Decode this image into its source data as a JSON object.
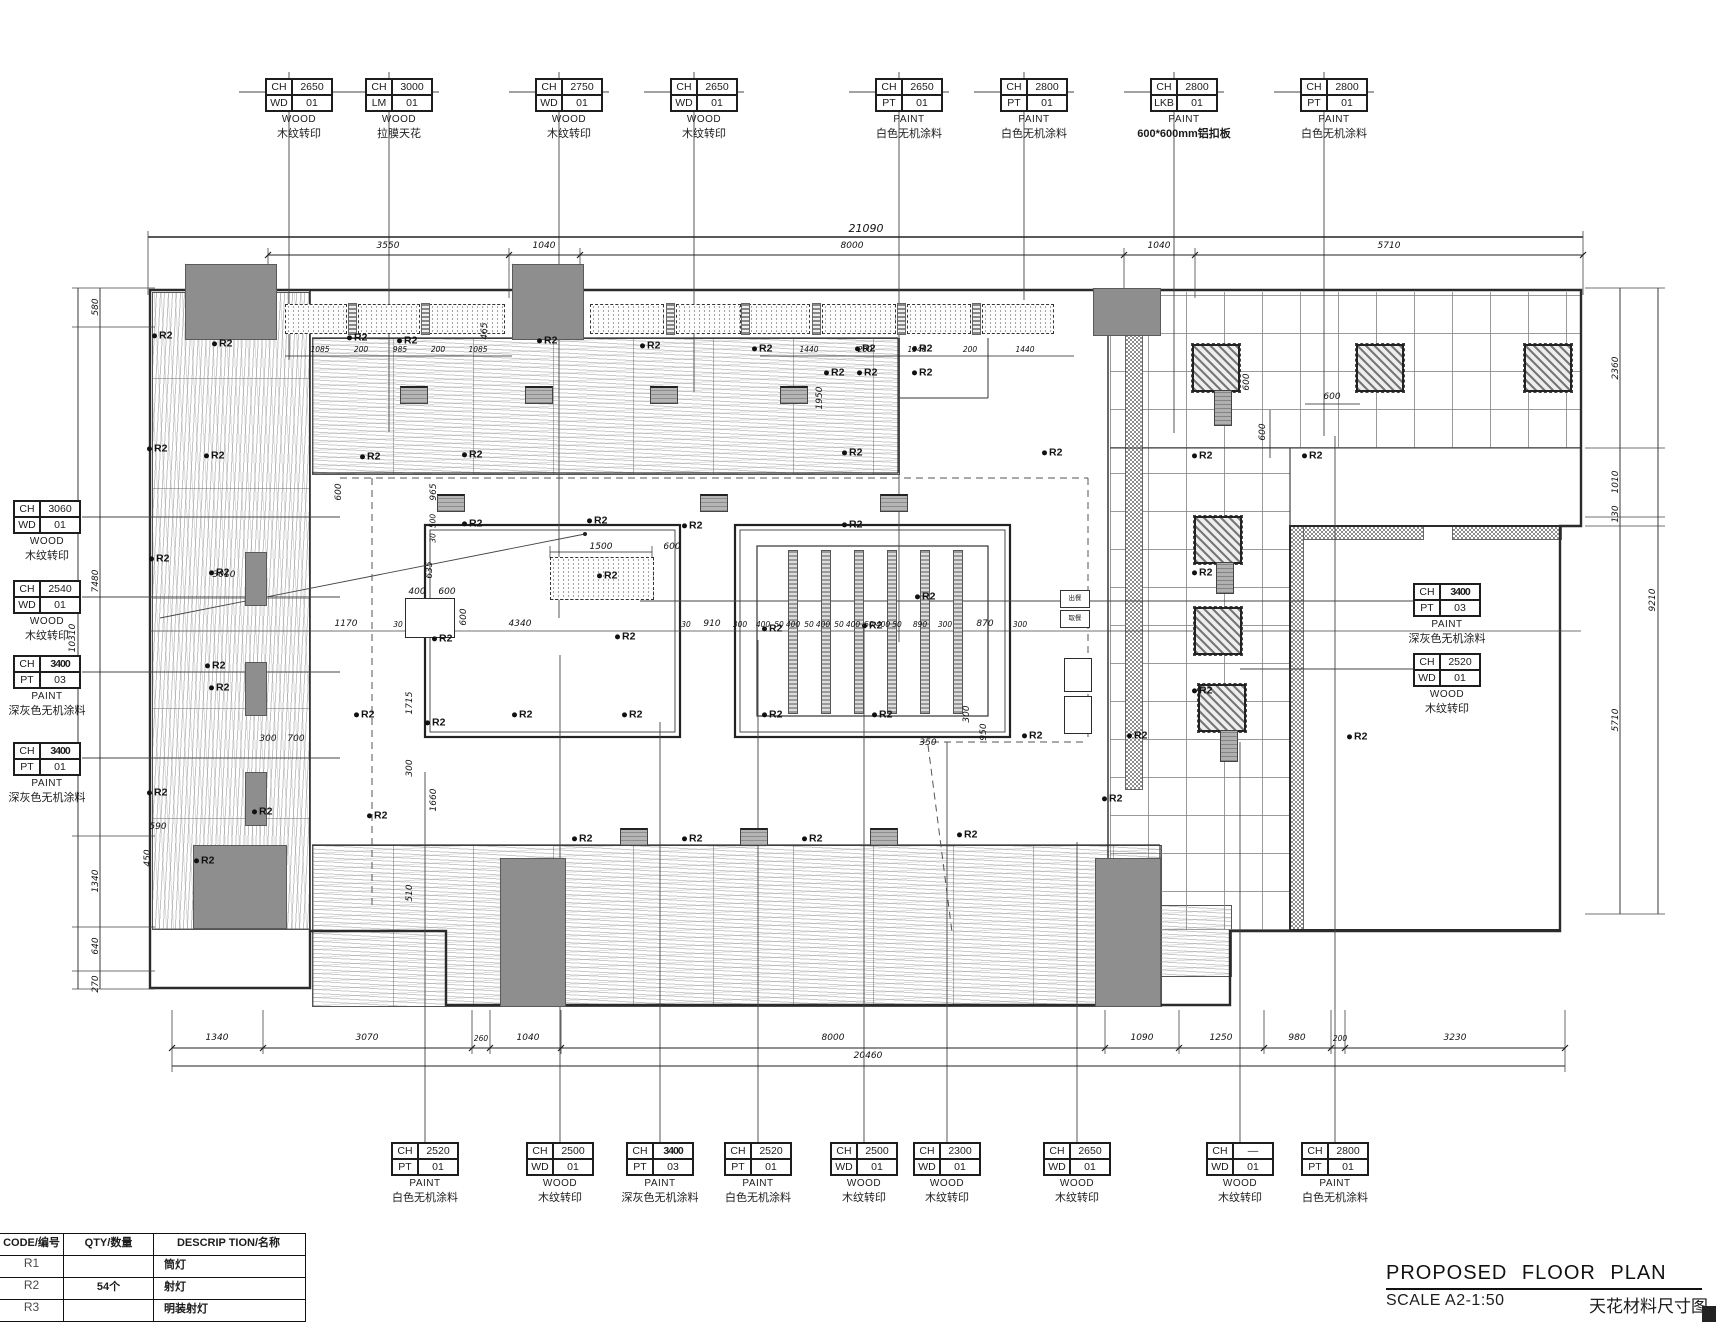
{
  "meta": {
    "ch": "CH",
    "r2": "R2"
  },
  "title_block": {
    "title": "PROPOSED FLOOR PLAN",
    "scale": "SCALE A2-1:50",
    "caption": "天花材料尺寸图"
  },
  "legend": {
    "headers": [
      "CODE/编号",
      "QTY/数量",
      "DESCRIP TION/名称"
    ],
    "rows": [
      {
        "code": "R1",
        "qty": "",
        "desc": "筒灯"
      },
      {
        "code": "R2",
        "qty": "54个",
        "desc": "射灯"
      },
      {
        "code": "R3",
        "qty": "",
        "desc": "明装射灯"
      }
    ]
  },
  "callouts": {
    "top": [
      {
        "ch_val": "2650",
        "code": "WD",
        "code_val": "01",
        "mat": "WOOD",
        "desc": "木纹转印"
      },
      {
        "ch_val": "3000",
        "code": "LM",
        "code_val": "01",
        "mat": "WOOD",
        "desc": "拉膜天花"
      },
      {
        "ch_val": "2750",
        "code": "WD",
        "code_val": "01",
        "mat": "WOOD",
        "desc": "木纹转印"
      },
      {
        "ch_val": "2650",
        "code": "WD",
        "code_val": "01",
        "mat": "WOOD",
        "desc": "木纹转印"
      },
      {
        "ch_val": "2650",
        "code": "PT",
        "code_val": "01",
        "mat": "PAINT",
        "desc": "白色无机涂料"
      },
      {
        "ch_val": "2800",
        "code": "PT",
        "code_val": "01",
        "mat": "PAINT",
        "desc": "白色无机涂料"
      },
      {
        "ch_val": "2800",
        "code": "LKB",
        "code_val": "01",
        "mat": "PAINT",
        "desc": "600*600mm铝扣板"
      },
      {
        "ch_val": "2800",
        "code": "PT",
        "code_val": "01",
        "mat": "PAINT",
        "desc": "白色无机涂料"
      }
    ],
    "left": [
      {
        "ch_val": "3060",
        "code": "WD",
        "code_val": "01",
        "mat": "WOOD",
        "desc": "木纹转印"
      },
      {
        "ch_val": "2540",
        "code": "WD",
        "code_val": "01",
        "mat": "WOOD",
        "desc": "木纹转印"
      },
      {
        "ch_val": "3400",
        "code": "PT",
        "code_val": "03",
        "mat": "PAINT",
        "desc": "深灰色无机涂料"
      },
      {
        "ch_val": "3400",
        "code": "PT",
        "code_val": "01",
        "mat": "PAINT",
        "desc": "深灰色无机涂料"
      }
    ],
    "right": [
      {
        "ch_val": "3400",
        "code": "PT",
        "code_val": "03",
        "mat": "PAINT",
        "desc": "深灰色无机涂料"
      },
      {
        "ch_val": "2520",
        "code": "WD",
        "code_val": "01",
        "mat": "WOOD",
        "desc": "木纹转印"
      }
    ],
    "bottom": [
      {
        "ch_val": "2520",
        "code": "PT",
        "code_val": "01",
        "mat": "PAINT",
        "desc": "白色无机涂料"
      },
      {
        "ch_val": "2500",
        "code": "WD",
        "code_val": "01",
        "mat": "WOOD",
        "desc": "木纹转印"
      },
      {
        "ch_val": "3400",
        "code": "PT",
        "code_val": "03",
        "mat": "PAINT",
        "desc": "深灰色无机涂料"
      },
      {
        "ch_val": "2520",
        "code": "PT",
        "code_val": "01",
        "mat": "PAINT",
        "desc": "白色无机涂料"
      },
      {
        "ch_val": "2500",
        "code": "WD",
        "code_val": "01",
        "mat": "WOOD",
        "desc": "木纹转印"
      },
      {
        "ch_val": "2300",
        "code": "WD",
        "code_val": "01",
        "mat": "WOOD",
        "desc": "木纹转印"
      },
      {
        "ch_val": "2650",
        "code": "WD",
        "code_val": "01",
        "mat": "WOOD",
        "desc": "木纹转印"
      },
      {
        "ch_val": "—",
        "code": "WD",
        "code_val": "01",
        "mat": "WOOD",
        "desc": "木纹转印"
      },
      {
        "ch_val": "2800",
        "code": "PT",
        "code_val": "01",
        "mat": "PAINT",
        "desc": "白色无机涂料"
      }
    ]
  },
  "dims": {
    "top_total": "21090",
    "top_chain": [
      "3550",
      "1040",
      "8000",
      "1040",
      "5710"
    ],
    "bottom_chain": [
      "1340",
      "3070",
      "260",
      "1040",
      "8000",
      "1090",
      "1250",
      "980",
      "200",
      "3230"
    ],
    "bottom_total": "20460",
    "left_chain": [
      "580",
      "7480",
      "1340",
      "640",
      "270"
    ],
    "left_total": "10310",
    "right_chain": [
      "2360",
      "1010",
      "130",
      "5710"
    ],
    "right_total": "9210",
    "lightbox_a": [
      "1085",
      "200",
      "985",
      "200",
      "1085"
    ],
    "lightbox_b": [
      "1440",
      "200",
      "1340",
      "200",
      "1440"
    ]
  },
  "small": {
    "v30": "30",
    "v50": "50",
    "v300": "300",
    "v350": "350",
    "v400": "400",
    "v450": "450",
    "v465": "465",
    "v500": "500",
    "v510": "510",
    "v590": "590",
    "v600": "600",
    "v635": "635",
    "v700": "700",
    "v870": "870",
    "v890": "890",
    "v910": "910",
    "v950": "950",
    "v965": "965",
    "v1170": "1170",
    "v1500": "1500",
    "v1660": "1660",
    "v1715": "1715",
    "v1950": "1950",
    "v3010": "3010",
    "v4340": "4340"
  },
  "kitchen": {
    "serve": "出餐",
    "pickup": "取餐"
  }
}
